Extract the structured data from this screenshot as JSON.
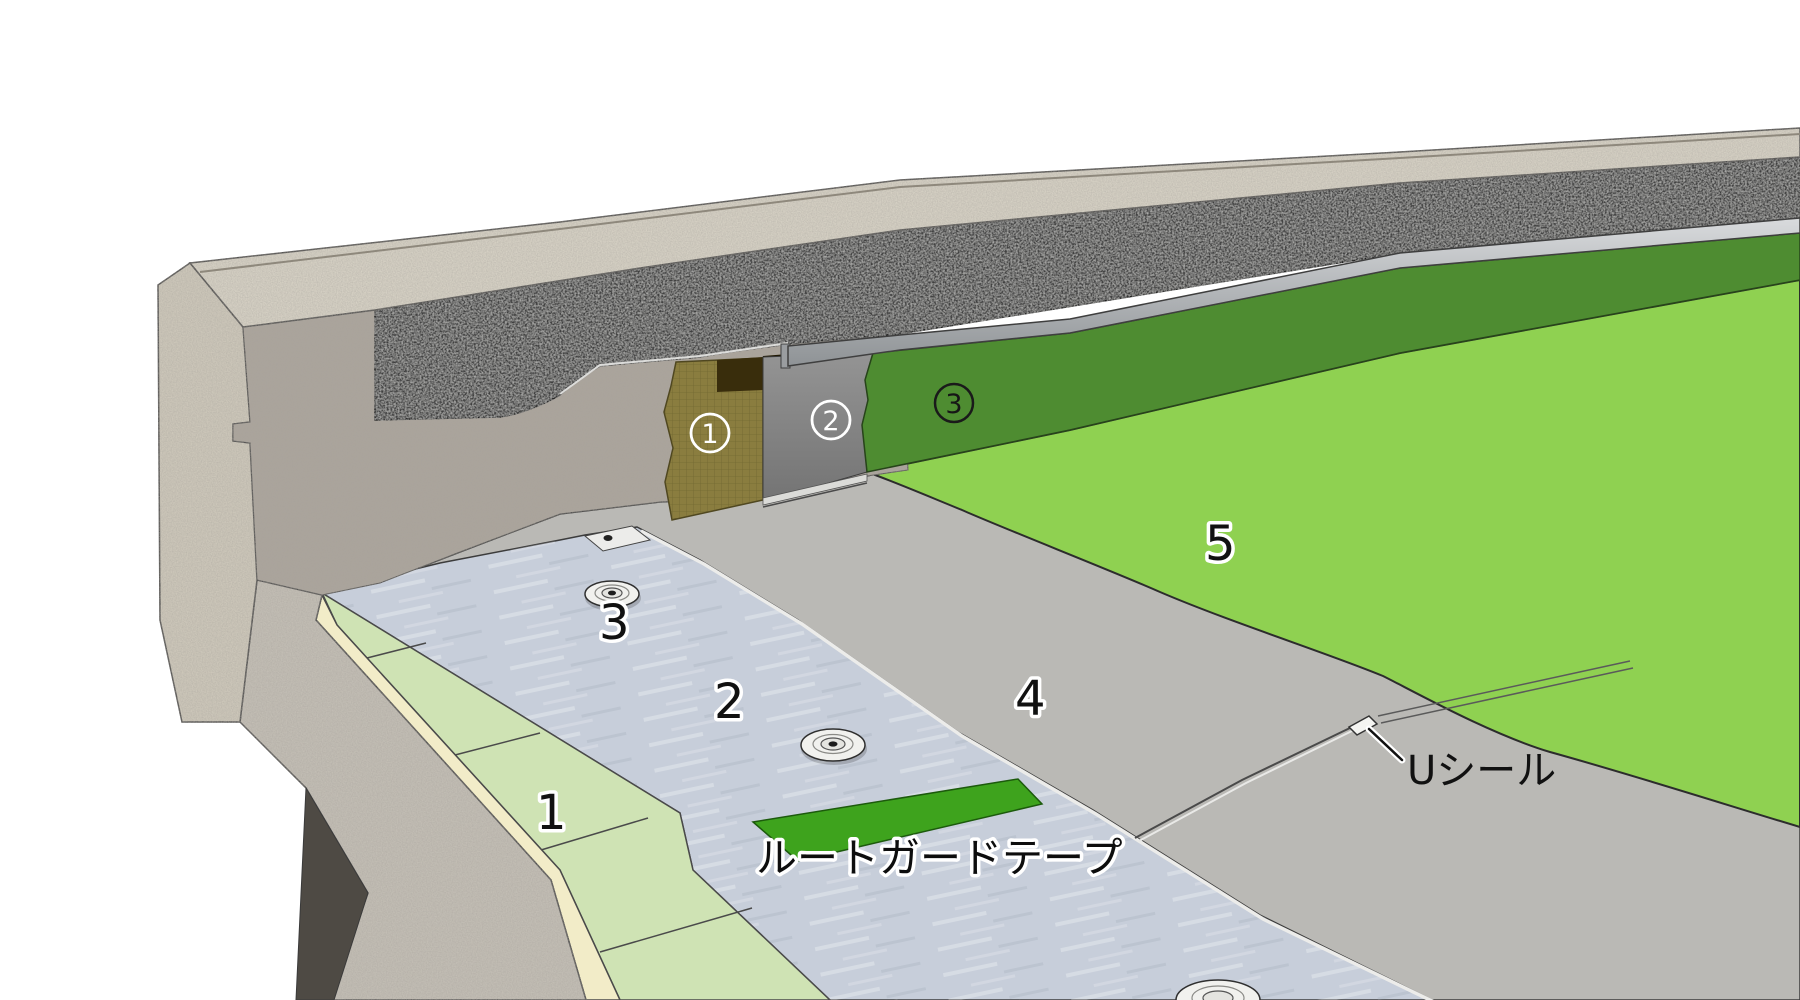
{
  "diagram": {
    "type": "roof-waterproofing-parapet-detail",
    "field_labels": {
      "l1": "1",
      "l2": "2",
      "l3": "3",
      "l4": "4",
      "l5": "5"
    },
    "wall_labels": {
      "c1": "1",
      "c2": "2",
      "c3": "3"
    },
    "annotations": {
      "tape": "ルートガードテープ",
      "seal": "Uシール"
    },
    "colors": {
      "background": "#FFFFFF",
      "membrane_green": "#8FD151",
      "upstand_green": "#4E8C31",
      "tape_green": "#3EA31D",
      "insulation_green": "#CFE3B4",
      "insulation_edge_cream": "#F2ECC8",
      "sheet2_blue_gray": "#C7CEDA",
      "sheet4_gray": "#BAB9B5",
      "asphalt_dark": "#414141",
      "concrete_cap": "#D8D3C6",
      "concrete_outer": "#CFC9BB",
      "concrete_wall": "#ABA59C",
      "concrete_slab": "#C4BFB6",
      "shadow_notch": "#4E4A44",
      "metal_bar": "#B9BCBF",
      "olive_board": "#8A7D3F",
      "recess_brown": "#392D0C"
    }
  }
}
